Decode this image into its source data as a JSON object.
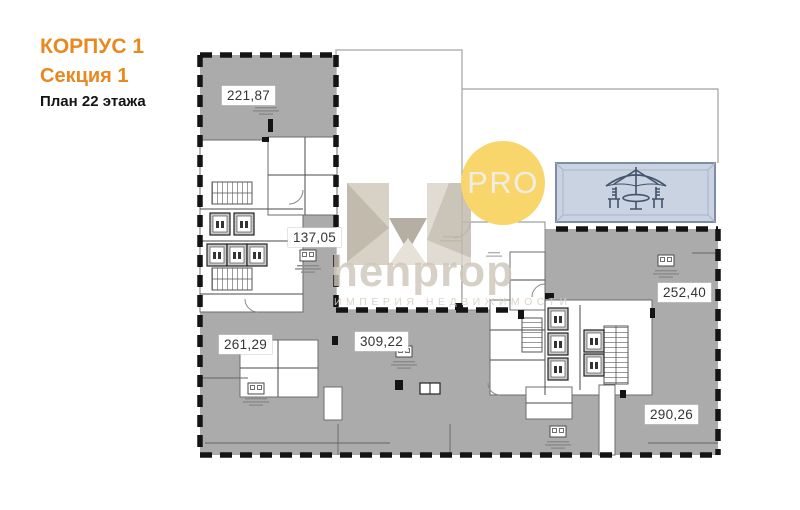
{
  "header": {
    "building": "КОРПУС 1",
    "section": "Секция 1",
    "floor_plan": "План 22 этажа"
  },
  "plan": {
    "areas": [
      {
        "name": "apartment-top-left",
        "value": "221,87"
      },
      {
        "name": "apartment-mid-left",
        "value": "137,05"
      },
      {
        "name": "apartment-bottom-left",
        "value": "261,29"
      },
      {
        "name": "apartment-bottom-middle",
        "value": "309,22"
      },
      {
        "name": "apartment-right",
        "value": "252,40"
      },
      {
        "name": "apartment-bottom-right",
        "value": "290,26"
      }
    ],
    "features": [
      "terrace-with-umbrella",
      "elevator-core-left",
      "elevator-core-right",
      "stairs",
      "kitchen-zones"
    ]
  },
  "watermark": {
    "brand": "henprop",
    "tagline": "ИМПЕРИЯ НЕДВИЖИМОСТИ",
    "badge": "PRO"
  },
  "colors": {
    "accent_orange": "#E8891F",
    "plan_gray": "#ABABAB",
    "terrace_blue": "#C9D3E1",
    "terrace_line": "#44536C",
    "badge_yellow": "#F8D66B",
    "watermark_beige": "#CEC6B9"
  }
}
